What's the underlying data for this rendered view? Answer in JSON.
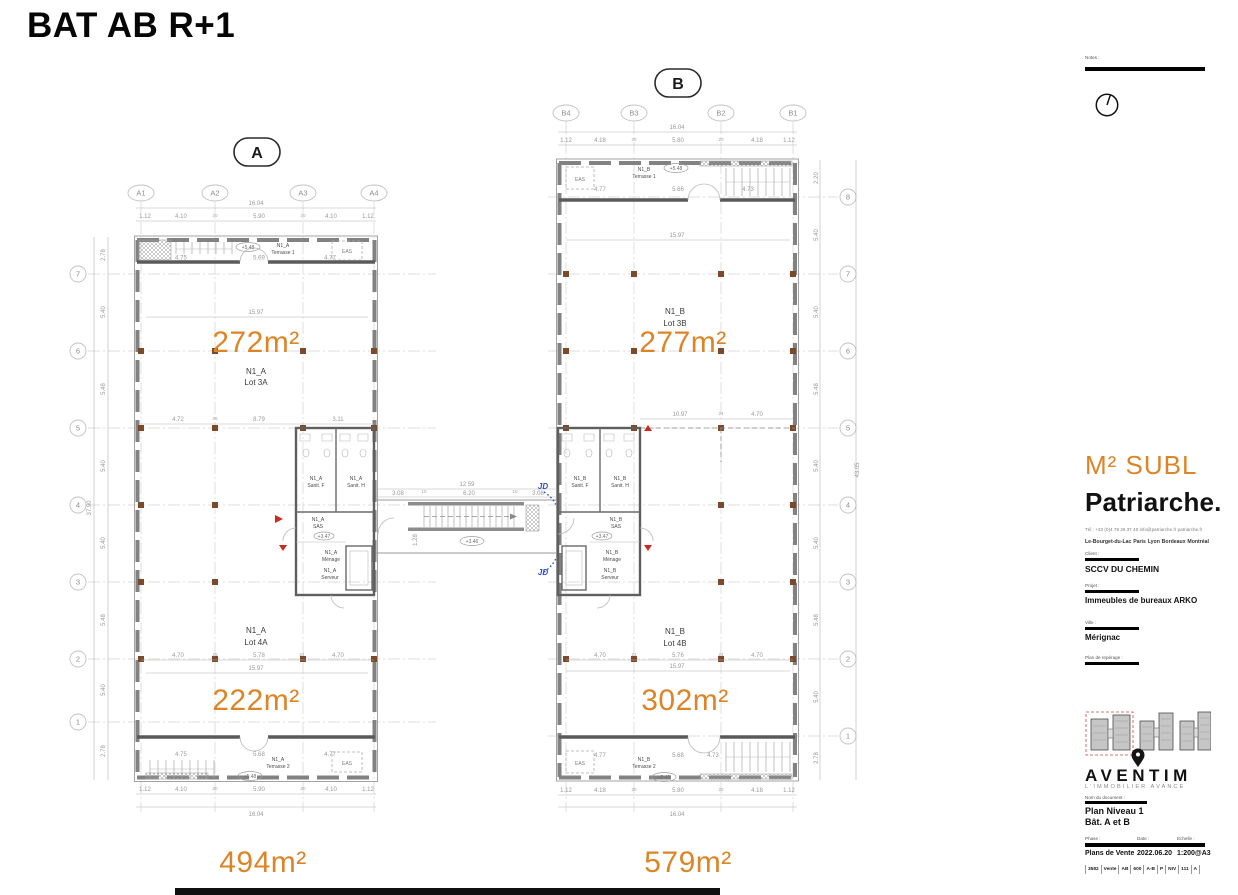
{
  "title": "BAT AB R+1",
  "colors": {
    "accent": "#DD8426",
    "red": "#CC2A1E",
    "blue": "#2A4FC7",
    "column": "#7B4A2A"
  },
  "plan_a": {
    "marker": "A",
    "cols": [
      "A1",
      "A2",
      "A3",
      "A4"
    ],
    "rows": [
      "7",
      "6",
      "5",
      "4",
      "3",
      "2",
      "1"
    ],
    "row_dims": [
      "2.78",
      "5.40",
      "5.48",
      "5.40",
      "5.40",
      "5.48",
      "5.40",
      "2.78"
    ],
    "row_total": "37.90",
    "top_dims": [
      "1.12",
      "4.10",
      "20",
      "5.90",
      "20",
      "4.10",
      "1.12"
    ],
    "top_total": "16.04",
    "bottom_dims": [
      "1.12",
      "4.10",
      "20",
      "5.90",
      "20",
      "4.10",
      "1.12"
    ],
    "bottom_total": "16.04",
    "lot3": {
      "area": "272m²",
      "name": "N1_A",
      "lot": "Lot 3A",
      "width": "15.97",
      "chain": [
        "4.72",
        "26",
        "8.79",
        "3.11"
      ]
    },
    "lot4": {
      "area": "222m²",
      "name": "N1_A",
      "lot": "Lot 4A",
      "width": "15.97",
      "chain": [
        "4.70",
        "26",
        "5.78",
        "24",
        "4.70"
      ]
    },
    "terrace1": {
      "name": "N1_A",
      "label": "Terrasse 1",
      "level": "+5.48",
      "eas": "EAS",
      "dims": [
        "4.75",
        "5.69",
        "4.77"
      ]
    },
    "terrace2": {
      "name": "N1_A",
      "label": "Terrasse 2",
      "level": "+5.48",
      "eas": "EAS",
      "dims": [
        "4.75",
        "5.68",
        "4.77"
      ]
    },
    "core": {
      "name": "N1_A",
      "sanf": "Sanit. F",
      "sanh": "Sanit. H",
      "sas": "SAS",
      "sas_level": "+3.47",
      "menage": "Ménage",
      "serveur": "Serveur"
    },
    "total": "494m²"
  },
  "plan_b": {
    "marker": "B",
    "cols": [
      "B4",
      "B3",
      "B2",
      "B1"
    ],
    "rows": [
      "8",
      "7",
      "6",
      "5",
      "4",
      "3",
      "2",
      "1"
    ],
    "row_dims": [
      "2.20",
      "5.40",
      "5.40",
      "5.48",
      "5.40",
      "5.40",
      "5.48",
      "5.40",
      "2.78"
    ],
    "row_total": "43.05",
    "top_dims": [
      "1.12",
      "4.18",
      "20",
      "5.80",
      "20",
      "4.18",
      "1.12"
    ],
    "top_total": "16.04",
    "bottom_dims": [
      "1.12",
      "4.18",
      "20",
      "5.80",
      "20",
      "4.18",
      "1.12"
    ],
    "bottom_total": "16.04",
    "lot3": {
      "area": "277m²",
      "name": "N1_B",
      "lot": "Lot 3B",
      "width": "15.97",
      "chain": [
        "10.97",
        "24",
        "4.70"
      ]
    },
    "lot4": {
      "area": "302m²",
      "name": "N1_B",
      "lot": "Lot 4B",
      "width": "15.97",
      "chain": [
        "4.70",
        "24",
        "5.76",
        "24",
        "4.70"
      ]
    },
    "terrace1": {
      "name": "N1_B",
      "label": "Terrasse 1",
      "level": "+5.48",
      "eas": "EAS",
      "dims": [
        "4.77",
        "5.66",
        "4.73"
      ]
    },
    "terrace2": {
      "name": "N1_B",
      "label": "Terrasse 2",
      "level": "+5.48",
      "eas": "EAS",
      "dims": [
        "4.77",
        "5.68",
        "4.73"
      ]
    },
    "core": {
      "name": "N1_B",
      "sanf": "Sanit. F",
      "sanh": "Sanit. H",
      "sas": "SAS",
      "sas_level": "+3.47",
      "menage": "Ménage",
      "serveur": "Serveur"
    },
    "total": "579m²"
  },
  "bridge": {
    "total": "12.59",
    "seg_left": "3.08",
    "seg_t1": "10",
    "seg_mid": "6.20",
    "seg_t2": "10",
    "seg_right": "3.08",
    "level": "+3.46",
    "height": "1.28",
    "jd": "JD"
  },
  "sidebar": {
    "notes_label": "Notes :",
    "brand_sub": "M² SUBL",
    "brand": "Patriarche.",
    "contact": "Tél : +33 (0)4 79 26 37 40   info@patriarche.fr   patriarche.fr",
    "cities": [
      "Le-Bourget-du-Lac",
      "Paris",
      "Lyon",
      "Bordeaux",
      "Montréal"
    ],
    "client_label": "Client :",
    "client": "SCCV DU CHEMIN",
    "project_label": "Projet :",
    "project": "Immeubles de bureaux ARKO",
    "city_label": "Ville :",
    "city": "Mérignac",
    "locator_label": "Plan de repérage :",
    "logo": "AVENTIM",
    "logo_tagline": "L'IMMOBILIER AVANCE",
    "doc_label": "Nom du document :",
    "doc_line1": "Plan Niveau 1",
    "doc_line2": "Bât. A et B",
    "phase_label": "Phase :",
    "date_label": "Date :",
    "scale_label": "Echelle :",
    "phase": "Plans de Vente",
    "date": "2022.06.20",
    "scale": "1:200@A3",
    "codes": [
      "3582",
      "Vente",
      "AB",
      "600",
      "A-B",
      "P",
      "NIV",
      "111",
      "A"
    ]
  }
}
